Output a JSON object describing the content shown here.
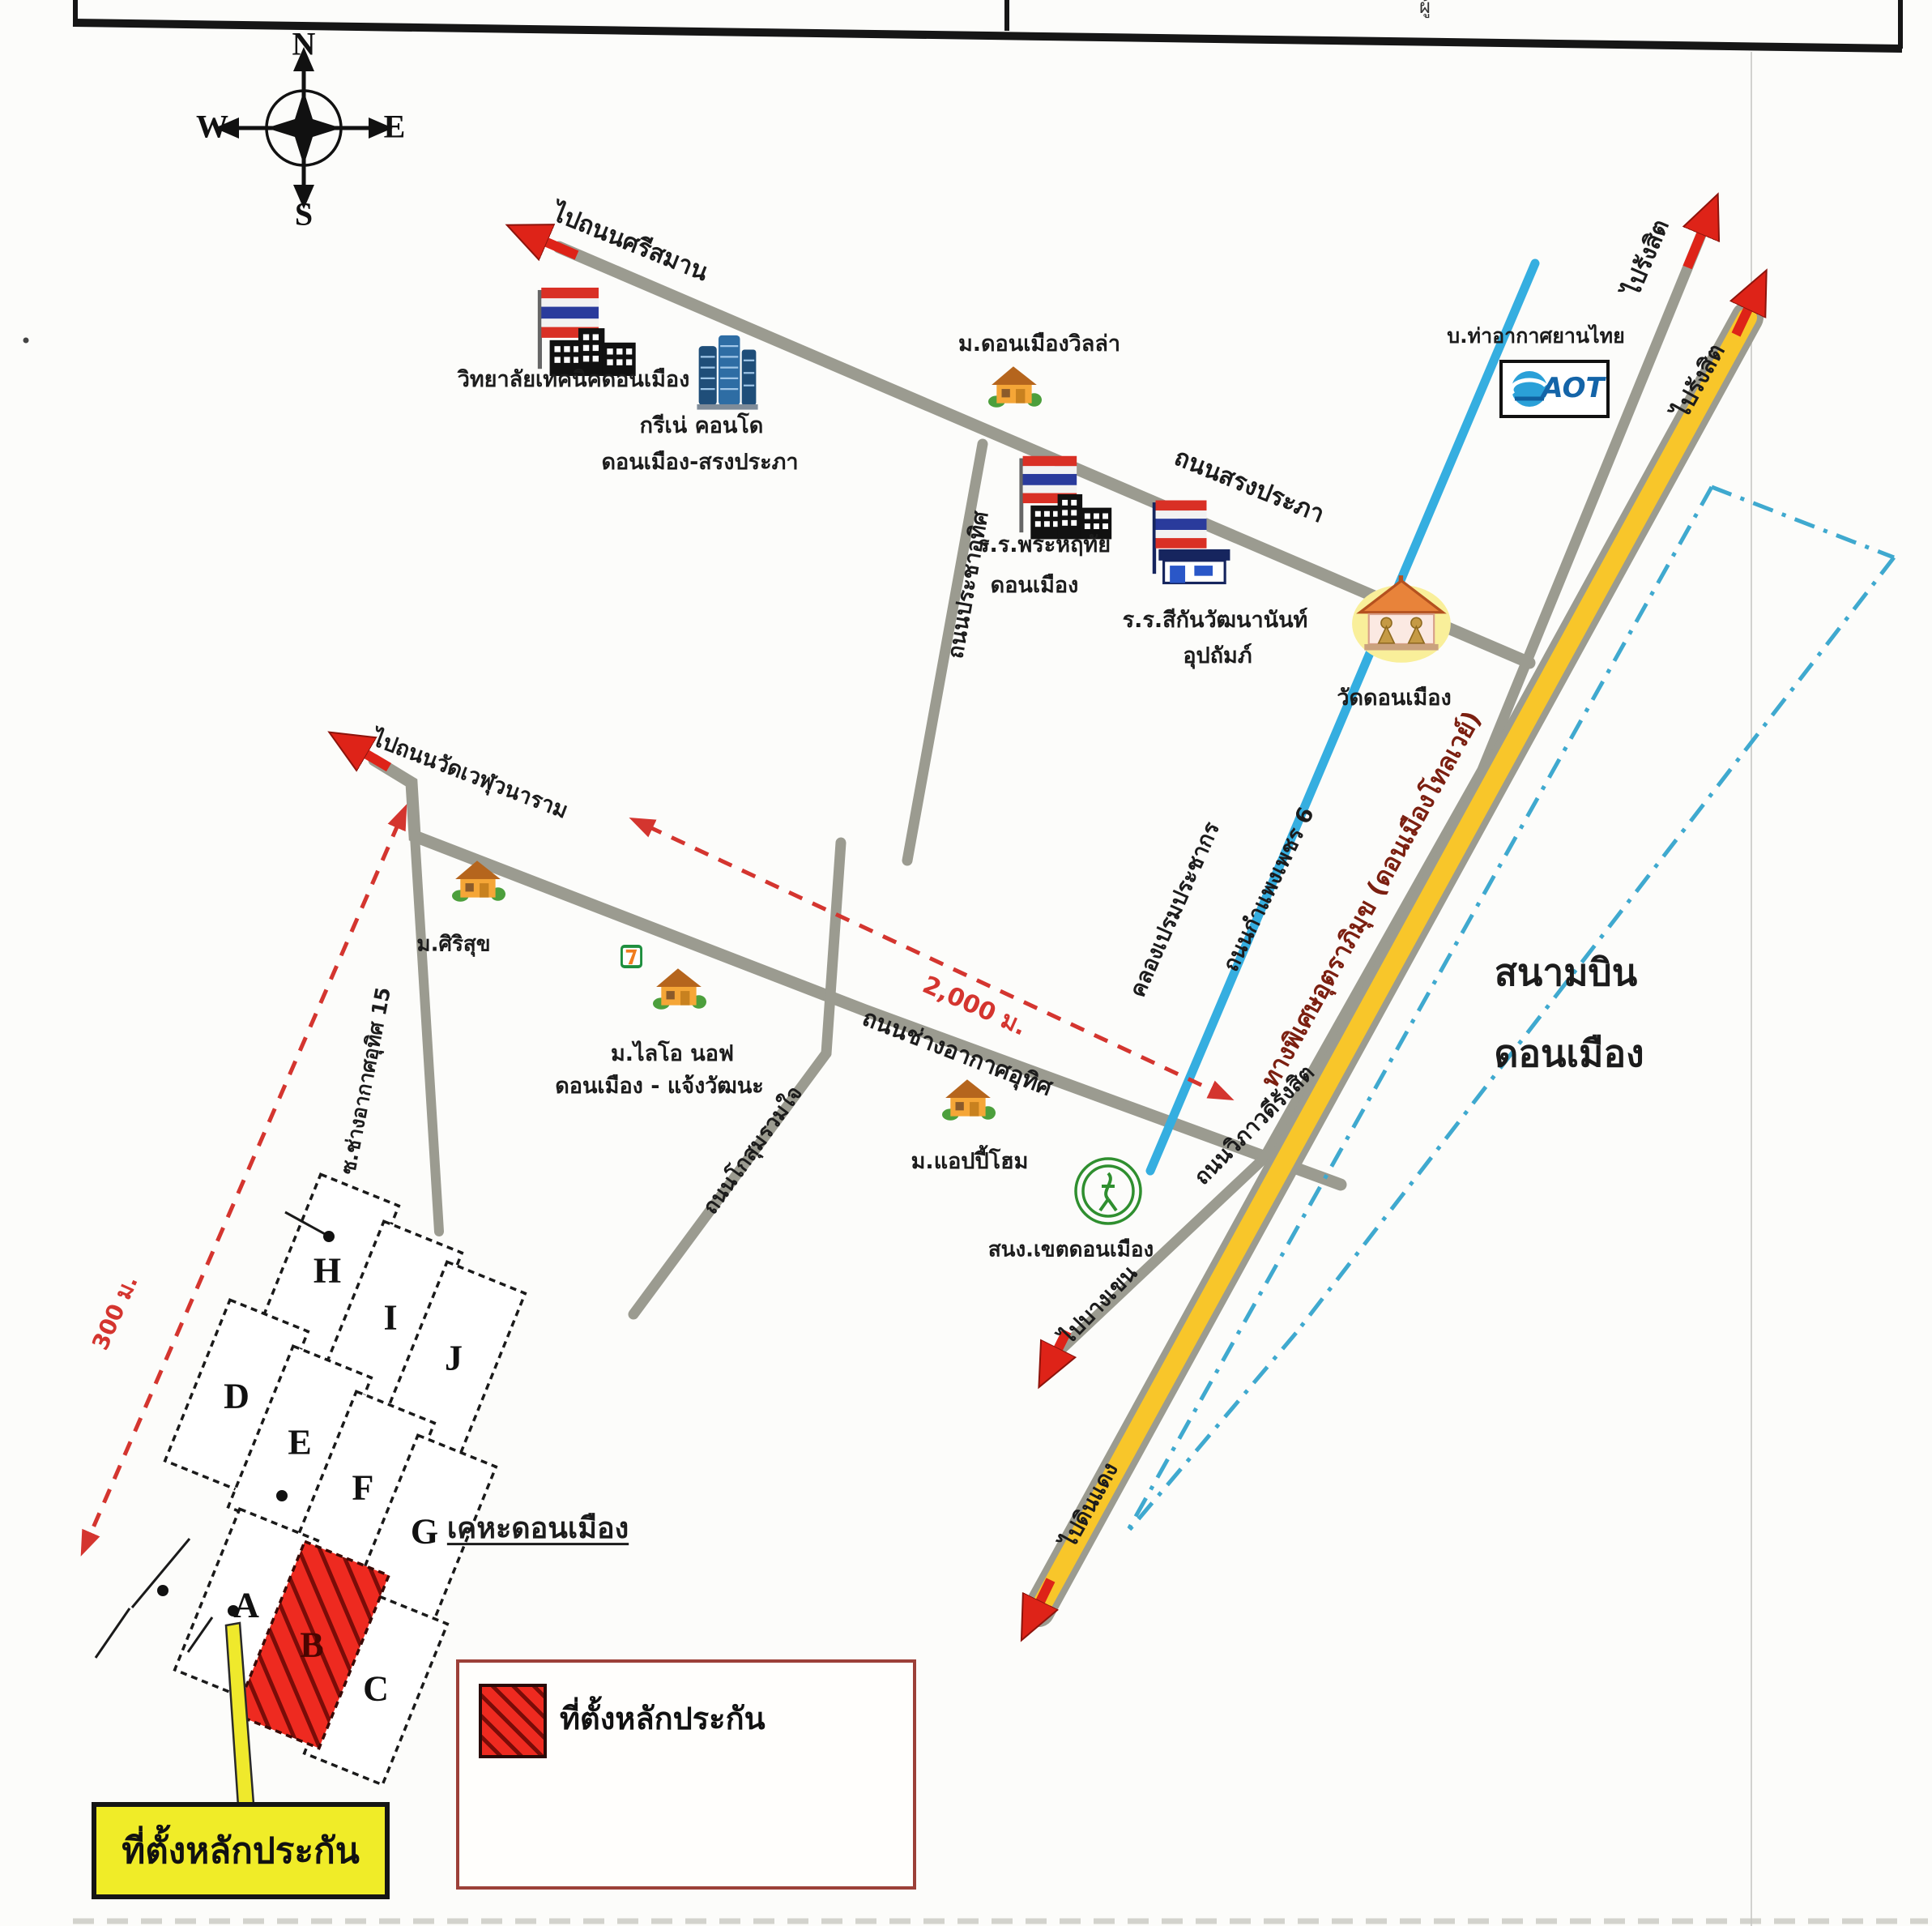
{
  "document": {
    "type": "scanned Thai location map, Don Mueang",
    "header_fragment": "ผู้"
  },
  "compass": {
    "north": "N",
    "south": "S",
    "east": "E",
    "west": "W"
  },
  "roads": {
    "to_sri_saman": "ไปถนนศรีสมาน",
    "songprapha": "ถนนสรงประภา",
    "prachauthit": "ถนนประชาอุทิศ",
    "chang_akat_uthit": "ถนนช่างอากาศอุทิศ",
    "kosum_ruamjai": "ถนนโกสุมรวมใจ",
    "soi_chang_akat_uthit_15": "ซ.ช่างอากาศอุทิศ 15",
    "to_wat_weluwanaram": "ไปถนนวัดเวฬุวนาราม",
    "kamphaengphet_6": "ถนนกำแพงเพชร 6",
    "viphavadi_rangsit": "ถนนวิภาวดีรังสิต",
    "tollway": "ทางพิเศษอุตราภิมุข (ดอนเมืองโทลเวย์)",
    "to_rangsit_local": "ไปรังสิต",
    "to_rangsit_tollway": "ไปรังสิต",
    "to_bang_khen": "ไปบางเขน",
    "to_din_daeng": "ไปดินแดง"
  },
  "canal": {
    "name": "คลองเปรมประชากร"
  },
  "places": {
    "technical_college": "วิทยาลัยเทคนิคดอนเมือง",
    "grene_condo_line1": "กรีเน่ คอนโด",
    "grene_condo_line2": "ดอนเมือง-สรงประภา",
    "donmueang_villa": "ม.ดอนเมืองวิลล่า",
    "phra_haruethai_line1": "ร.ร.พระหฤทัย",
    "phra_haruethai_line2": "ดอนเมือง",
    "sikan_school_line1": "ร.ร.สีกันวัฒนานันท์",
    "sikan_school_line2": "อุปถัมภ์",
    "wat_donmueang": "วัดดอนเมือง",
    "aot_company": "บ.ท่าอากาศยานไทย",
    "aot_logo": "AOT",
    "sirisuk": "ม.ศิริสุข",
    "lio_nov_line1": "ม.ไลโอ นอฟ",
    "lio_nov_line2": "ดอนเมือง - แจ้งวัฒนะ",
    "happy_home": "ม.แอปปี้โฮม",
    "district_office": "สนง.เขตดอนเมือง",
    "airport_line1": "สนามบิน",
    "airport_line2": "ดอนเมือง",
    "kheha_donmueang": "เคหะดอนเมือง"
  },
  "measurements": {
    "long": "2,000 ม.",
    "short": "300 ม."
  },
  "housing_plots": {
    "a": "A",
    "b": "B",
    "c": "C",
    "d": "D",
    "e": "E",
    "f": "F",
    "g": "G",
    "h": "H",
    "i": "I",
    "j": "J"
  },
  "legend": {
    "label": "ที่ตั้งหลักประกัน"
  },
  "callout": {
    "label": "ที่ตั้งหลักประกัน"
  },
  "colors": {
    "road": "#9b9b90",
    "canal": "#35aee0",
    "tollway": "#f8c62a",
    "arrow": "#de2318",
    "highlight": "#ee2a20",
    "callout_bg": "#f0ec28",
    "boundary": "#3fa9cf"
  }
}
